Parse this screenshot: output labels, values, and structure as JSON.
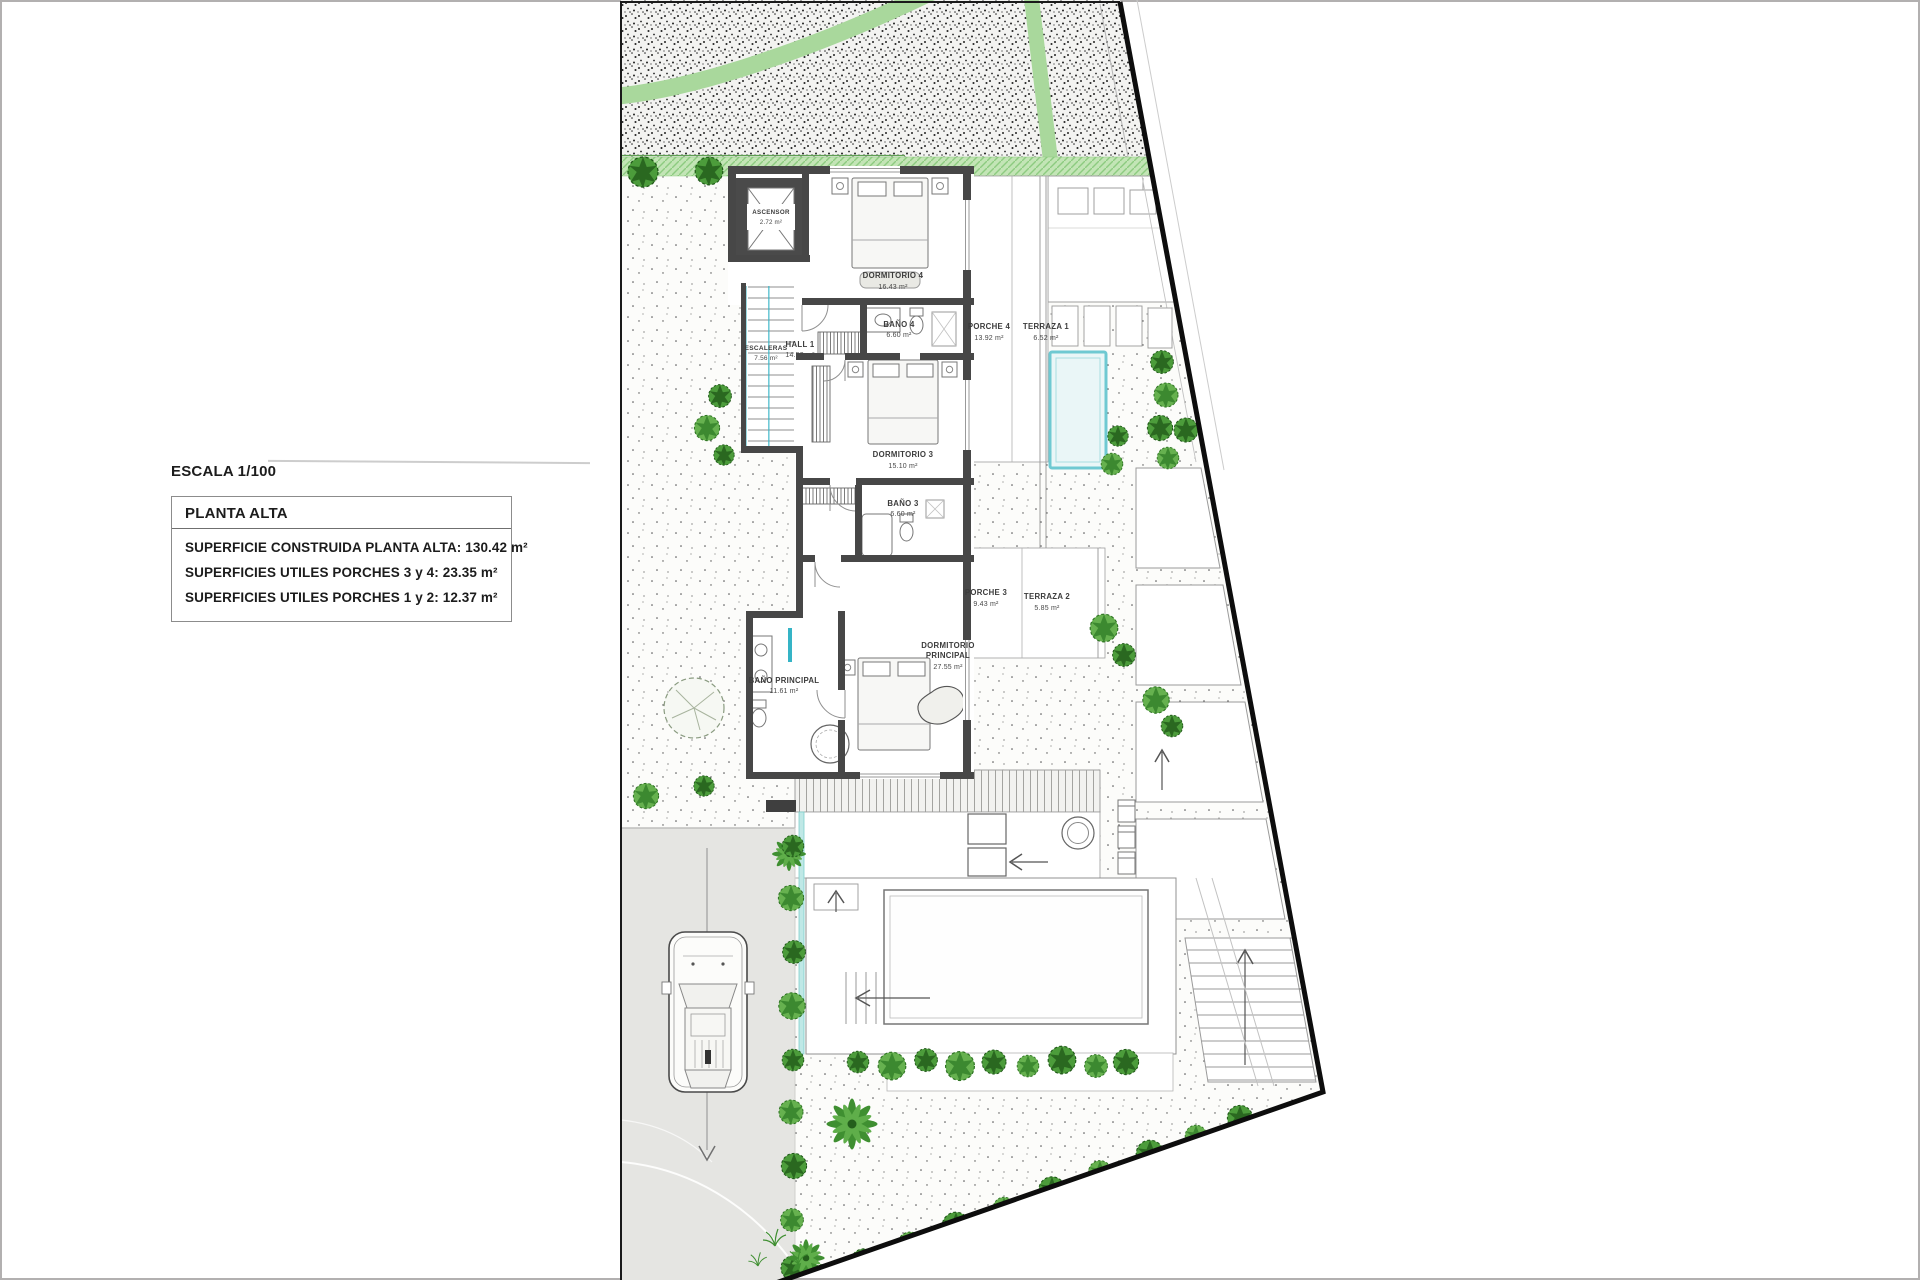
{
  "annotation": {
    "scale_label": "ESCALA 1/100",
    "box_title": "PLANTA ALTA",
    "lines": [
      "SUPERFICIE CONSTRUIDA PLANTA ALTA: 130.42 m²",
      "SUPERFICIES UTILES PORCHES 3 y 4: 23.35 m²",
      "SUPERFICIES UTILES PORCHES 1 y 2: 12.37 m²"
    ]
  },
  "plan": {
    "rooms": [
      {
        "id": "ascensor",
        "lines": [
          "ASCENSOR",
          "2.72 m²"
        ]
      },
      {
        "id": "dormitorio-4",
        "lines": [
          "DORMITORIO 4",
          "16.43 m²"
        ]
      },
      {
        "id": "bano-4",
        "lines": [
          "BAÑO 4",
          "6.60 m²"
        ]
      },
      {
        "id": "hall-1",
        "lines": [
          "HALL 1",
          "14.52 m²"
        ]
      },
      {
        "id": "escaleras",
        "lines": [
          "ESCALERAS",
          "7.56 m²"
        ]
      },
      {
        "id": "porche-4",
        "lines": [
          "PORCHE 4",
          "13.92 m²"
        ]
      },
      {
        "id": "terraza-1",
        "lines": [
          "TERRAZA 1",
          "6.52 m²"
        ]
      },
      {
        "id": "dormitorio-3",
        "lines": [
          "DORMITORIO 3",
          "15.10 m²"
        ]
      },
      {
        "id": "bano-3",
        "lines": [
          "BAÑO 3",
          "6.60 m²"
        ]
      },
      {
        "id": "porche-3",
        "lines": [
          "PORCHE 3",
          "9.43 m²"
        ]
      },
      {
        "id": "terraza-2",
        "lines": [
          "TERRAZA 2",
          "5.85 m²"
        ]
      },
      {
        "id": "dormitorio-principal",
        "lines": [
          "DORMITORIO",
          "PRINCIPAL",
          "27.55 m²"
        ]
      },
      {
        "id": "bano-principal",
        "lines": [
          "BAÑO PRINCIPAL",
          "11.61 m²"
        ]
      }
    ],
    "colors": {
      "wall": "#474747",
      "green_path": "#a9d89c",
      "green_strip": "#c3e5b6",
      "pool_edge": "#6fc9d2",
      "stair_accent": "#35b4c6",
      "driveway": "#e5e5e2",
      "speckle": "#2b2b2b"
    }
  }
}
